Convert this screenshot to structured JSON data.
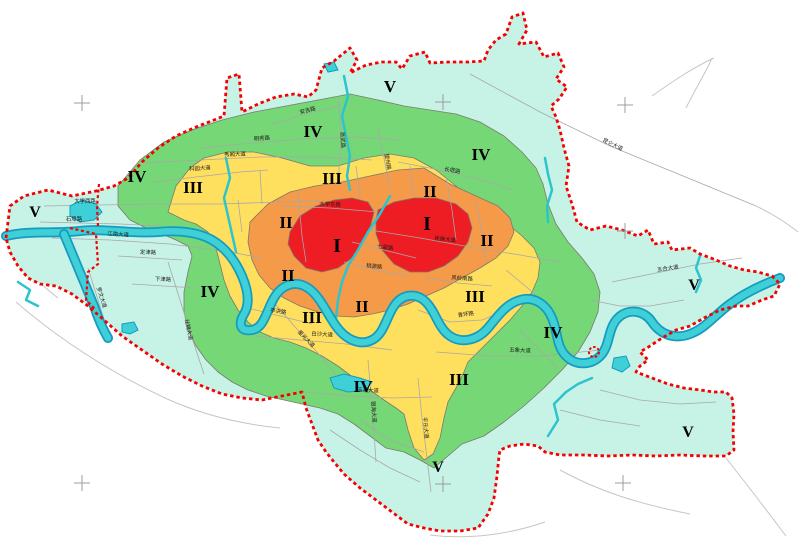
{
  "map": {
    "colors": {
      "zone_I": "#ee1c23",
      "zone_II": "#f59a49",
      "zone_III": "#ffe05e",
      "zone_IV": "#76d776",
      "zone_V": "#c7f2e6",
      "water_fill": "#3ed0d6",
      "water_edge": "#169bc0",
      "stream": "#2cc4cd",
      "boundary": "#f50000",
      "zone_border": "#7a7a6e",
      "road": "#a8a8a8",
      "outside_road": "#c6c6c6",
      "reg_mark": "#9c9c9c",
      "label": "#1a1a1a"
    },
    "zone_labels": [
      {
        "zone": "I",
        "x": 337,
        "y": 252,
        "size": 20
      },
      {
        "zone": "I",
        "x": 427,
        "y": 230,
        "size": 20
      },
      {
        "zone": "II",
        "x": 430,
        "y": 197,
        "size": 17
      },
      {
        "zone": "II",
        "x": 286,
        "y": 228,
        "size": 17
      },
      {
        "zone": "II",
        "x": 487,
        "y": 246,
        "size": 17
      },
      {
        "zone": "II",
        "x": 288,
        "y": 281,
        "size": 17
      },
      {
        "zone": "II",
        "x": 362,
        "y": 312,
        "size": 17
      },
      {
        "zone": "III",
        "x": 193,
        "y": 193,
        "size": 17
      },
      {
        "zone": "III",
        "x": 332,
        "y": 184,
        "size": 17
      },
      {
        "zone": "III",
        "x": 312,
        "y": 323,
        "size": 17
      },
      {
        "zone": "III",
        "x": 475,
        "y": 302,
        "size": 17
      },
      {
        "zone": "III",
        "x": 459,
        "y": 385,
        "size": 17
      },
      {
        "zone": "IV",
        "x": 313,
        "y": 137,
        "size": 17
      },
      {
        "zone": "IV",
        "x": 481,
        "y": 160,
        "size": 17
      },
      {
        "zone": "IV",
        "x": 137,
        "y": 182,
        "size": 17
      },
      {
        "zone": "IV",
        "x": 210,
        "y": 297,
        "size": 17
      },
      {
        "zone": "IV",
        "x": 553,
        "y": 338,
        "size": 17
      },
      {
        "zone": "IV",
        "x": 363,
        "y": 392,
        "size": 17
      },
      {
        "zone": "V",
        "x": 390,
        "y": 92,
        "size": 17
      },
      {
        "zone": "V",
        "x": 35,
        "y": 217,
        "size": 16
      },
      {
        "zone": "V",
        "x": 694,
        "y": 290,
        "size": 16
      },
      {
        "zone": "V",
        "x": 688,
        "y": 437,
        "size": 16
      },
      {
        "zone": "V",
        "x": 438,
        "y": 472,
        "size": 16
      }
    ],
    "road_labels": [
      {
        "text": "大学西路",
        "x": 85,
        "y": 203,
        "rot": 0
      },
      {
        "text": "石埠路",
        "x": 74,
        "y": 221,
        "rot": 0
      },
      {
        "text": "江南大道",
        "x": 118,
        "y": 236,
        "rot": 4
      },
      {
        "text": "科园大道",
        "x": 200,
        "y": 170,
        "rot": -4
      },
      {
        "text": "秀厢大道",
        "x": 235,
        "y": 156,
        "rot": -2
      },
      {
        "text": "明秀路",
        "x": 262,
        "y": 140,
        "rot": -4
      },
      {
        "text": "安吉路",
        "x": 308,
        "y": 112,
        "rot": -14
      },
      {
        "text": "邕武路",
        "x": 341,
        "y": 140,
        "rot": 87
      },
      {
        "text": "望州路",
        "x": 386,
        "y": 162,
        "rot": 80
      },
      {
        "text": "长堽路",
        "x": 452,
        "y": 172,
        "rot": 10
      },
      {
        "text": "大学东路",
        "x": 330,
        "y": 206,
        "rot": 2
      },
      {
        "text": "民族大道",
        "x": 445,
        "y": 241,
        "rot": 6
      },
      {
        "text": "七星路",
        "x": 385,
        "y": 249,
        "rot": 8
      },
      {
        "text": "桃源路",
        "x": 374,
        "y": 268,
        "rot": 6
      },
      {
        "text": "昆仑大道",
        "x": 612,
        "y": 146,
        "rot": 26
      },
      {
        "text": "五合大道",
        "x": 668,
        "y": 270,
        "rot": -8
      },
      {
        "text": "五象大道",
        "x": 520,
        "y": 352,
        "rot": 2
      },
      {
        "text": "青环路",
        "x": 466,
        "y": 316,
        "rot": -8
      },
      {
        "text": "凤岭南路",
        "x": 462,
        "y": 280,
        "rot": 4
      },
      {
        "text": "星光大道",
        "x": 305,
        "y": 340,
        "rot": 46
      },
      {
        "text": "亭洪路",
        "x": 278,
        "y": 313,
        "rot": 8
      },
      {
        "text": "白沙大道",
        "x": 322,
        "y": 336,
        "rot": 4
      },
      {
        "text": "壮锦大道",
        "x": 187,
        "y": 330,
        "rot": 78
      },
      {
        "text": "罗文大道",
        "x": 100,
        "y": 298,
        "rot": 72
      },
      {
        "text": "定津路",
        "x": 148,
        "y": 254,
        "rot": 2
      },
      {
        "text": "下津路",
        "x": 163,
        "y": 281,
        "rot": 2
      },
      {
        "text": "平乐大道",
        "x": 424,
        "y": 428,
        "rot": 84
      },
      {
        "text": "银海大道",
        "x": 372,
        "y": 412,
        "rot": 86
      },
      {
        "text": "玉洞大道",
        "x": 368,
        "y": 392,
        "rot": 2
      }
    ],
    "registration_marks": [
      {
        "x": 82,
        "y": 103
      },
      {
        "x": 443,
        "y": 102
      },
      {
        "x": 625,
        "y": 105
      },
      {
        "x": 625,
        "y": 231
      },
      {
        "x": 82,
        "y": 483
      },
      {
        "x": 443,
        "y": 484
      },
      {
        "x": 623,
        "y": 483
      }
    ],
    "geometry": {
      "boundary": "6,238 10,206 24,196 48,190 72,196 96,191 114,186 128,178 142,162 158,148 176,136 196,127 214,120 224,116 227,78 239,74 242,112 258,104 276,97 294,94 308,97 316,90 322,68 334,61 350,48 357,60 350,73 366,65 382,62 396,62 402,69 410,56 425,52 430,63 448,62 468,62 484,61 488,50 496,40 506,34 512,17 523,13 527,30 519,44 536,42 544,57 558,53 564,67 556,79 567,87 559,99 551,106 556,117 560,130 564,148 569,166 566,186 572,204 577,222 590,230 606,226 622,230 638,236 648,230 654,244 668,242 672,250 690,248 700,254 716,260 730,266 744,270 758,272 772,276 780,284 774,296 762,300 748,306 736,306 720,310 704,318 690,326 676,330 662,338 650,346 640,352 648,360 640,366 636,372 652,378 668,384 684,388 700,390 714,392 726,392 732,398 734,414 733,432 734,450 726,456 704,456 680,455 656,456 632,455 608,456 584,455 560,455 545,452 538,446 524,444 510,446 500,450 499,456 497,476 494,498 488,514 478,528 460,531 440,531 424,528 408,524 392,512 376,500 360,488 344,474 334,462 326,452 318,440 312,424 306,408 302,392 282,396 262,400 242,398 222,394 202,386 182,376 162,364 142,350 122,336 104,320 88,306 72,294 56,286 40,284 28,278 18,266 10,252",
      "zones": [
        {
          "level": "IV",
          "points": "118,186 140,160 164,142 192,130 222,120 254,112 286,106 318,100 350,94 378,100 404,106 430,110 456,114 480,122 504,136 522,152 536,168 543,184 548,204 556,224 568,242 582,258 594,274 600,292 598,312 590,332 578,352 562,370 544,388 524,406 504,422 484,436 462,444 448,456 434,468 420,460 404,452 386,448 370,436 354,424 338,414 320,408 302,404 284,400 266,396 248,390 232,382 218,372 206,360 196,346 188,330 184,312 184,292 188,272 192,256 188,246 176,240 162,234 146,228 130,220 118,206"
        },
        {
          "level": "III",
          "points": "168,212 176,186 190,168 204,158 228,152 254,152 282,158 310,166 338,166 364,158 390,154 414,158 436,170 456,186 472,200 490,212 508,224 522,236 534,248 540,262 538,278 532,292 522,306 510,320 496,334 482,348 468,362 464,372 456,388 448,402 444,418 440,438 433,454 424,460 414,448 408,430 404,414 396,408 384,400 370,390 354,378 338,366 322,356 306,348 290,342 274,338 260,332 248,322 238,310 230,296 224,280 220,264 216,248 208,232 196,224 184,220"
        },
        {
          "level": "II",
          "points": "250,222 268,204 290,192 315,186 342,182 370,176 398,170 424,168 450,184 476,196 498,206 510,218 514,232 508,246 496,258 480,268 462,278 444,288 426,296 408,304 390,310 372,314 354,317 336,316 318,312 300,306 284,298 270,288 259,275 252,260 248,242"
        },
        {
          "level": "I",
          "points": "290,232 300,216 316,206 334,200 352,198 368,202 374,212 370,228 362,244 352,258 338,268 322,272 306,268 294,256 288,244"
        },
        {
          "level": "I",
          "points": "378,210 394,202 414,198 436,198 456,204 468,214 472,228 468,242 458,256 444,266 428,272 410,272 394,264 382,250 376,234 376,220"
        }
      ],
      "river": [
        "M 6,236 C 30,230 55,234 80,231 C 105,228 130,234 158,232 C 178,230 198,232 212,240 C 226,248 236,262 242,276 C 248,290 250,304 244,314 C 238,324 240,332 252,330 C 264,328 266,312 274,298 C 282,284 296,280 308,288 C 320,296 326,312 336,326 C 346,340 360,346 372,340 C 384,334 386,318 394,306 C 402,294 416,292 426,302 C 436,312 438,328 450,336 C 462,344 478,340 488,328 C 498,316 506,304 520,300 C 534,296 546,304 552,318 C 558,332 556,346 566,356 C 576,366 592,366 602,354 C 610,344 608,328 618,318 C 628,308 644,310 652,322 C 660,334 674,340 690,334 C 706,328 716,314 730,304 C 746,292 764,284 780,278",
        "M 64,234 C 74,258 84,282 94,306 C 98,318 102,328 108,338"
      ],
      "streams": [
        "344,76 348,96 342,116 346,136 350,156 347,176 350,190",
        "390,196 380,214 368,232 358,250 348,266 342,282 338,300 336,318 336,330",
        "226,158 230,178 224,198 228,216 232,234 236,252",
        "545,158 548,174 552,190 547,206 548,222",
        "548,436 558,420 554,404 566,392 578,384 592,378",
        "700,256 696,268 701,280 696,292",
        "18,282 30,290 26,300 38,306"
      ],
      "lakes": [
        "70,206 82,200 96,204 102,212 94,220 80,222 70,216",
        "122,324 134,322 138,330 130,334 122,332",
        "330,378 344,374 360,378 372,382 366,390 348,392 334,388",
        "614,358 626,356 630,366 622,372 612,368",
        "324,64 334,62 338,70 328,72"
      ],
      "roads": [
        "44,206 100,205 160,204 220,204 280,202 320,201",
        "40,222 80,223 120,224 160,226",
        "52,238 110,240 170,244 230,252 262,258",
        "152,182 196,177 240,172 268,170",
        "140,163 200,160 260,157 320,157 372,160",
        "200,148 252,143 304,139 356,137 400,140",
        "272,124 306,114 342,105",
        "338,96 341,126 340,156 338,186",
        "378,128 384,158 390,188",
        "398,162 440,170 482,180 512,190",
        "370,230 420,238 470,247 520,255 560,262",
        "352,242 384,250 416,258",
        "344,262 376,270 408,276",
        "248,308 280,316 312,324",
        "256,336 300,340 346,344 392,350",
        "270,298 296,328 322,358 346,388",
        "168,262 180,300 192,338 204,374",
        "88,268 98,300 108,332",
        "118,256 150,258 182,260",
        "132,284 164,286 196,288",
        "436,352 490,356 544,356 600,350",
        "368,360 371,396 374,432 376,462",
        "418,378 422,418 427,458 431,492",
        "306,392 348,396 392,398 432,397",
        "418,310 450,322 482,320 512,308",
        "426,278 458,283 492,286",
        "612,282 656,273 700,264 742,258",
        "298,192 302,236 306,262",
        "410,166 414,196",
        "446,176 452,210 456,240",
        "476,200 482,232 486,262",
        "238,200 242,232",
        "260,170 262,204",
        "356,166 360,196",
        "282,206 330,208 378,212",
        "506,270 530,290 552,310",
        "520,330 540,350 558,368",
        "590,300 620,306 650,306 684,300",
        "600,390 640,400 680,404 716,402",
        "560,410 600,420 640,426",
        "330,430 360,450 390,468 420,482",
        "360,420 390,440 424,452",
        "470,74 540,112 610,146 688,178 756,206"
      ],
      "outside_roads": [
        "M 652,96 C 672,82 692,68 714,58",
        "M 686,108 C 696,88 706,72 712,58",
        "M 756,206 C 775,215 788,224 798,232",
        "M 16,302 C 60,340 110,372 165,398 C 200,414 240,424 280,428",
        "M 430,535 C 470,540 510,534 545,522",
        "M 560,470 C 600,492 640,504 690,514",
        "M 726,458 C 748,486 768,512 786,536",
        "M 8,252 C 24,268 40,284 58,298"
      ],
      "inner_dashes": [
        "70,228 96,234 98,264 88,272 86,300 96,310",
        "99,184 97,206 98,226"
      ],
      "boundary_circle": {
        "cx": 594,
        "cy": 352,
        "r": 5
      }
    }
  }
}
